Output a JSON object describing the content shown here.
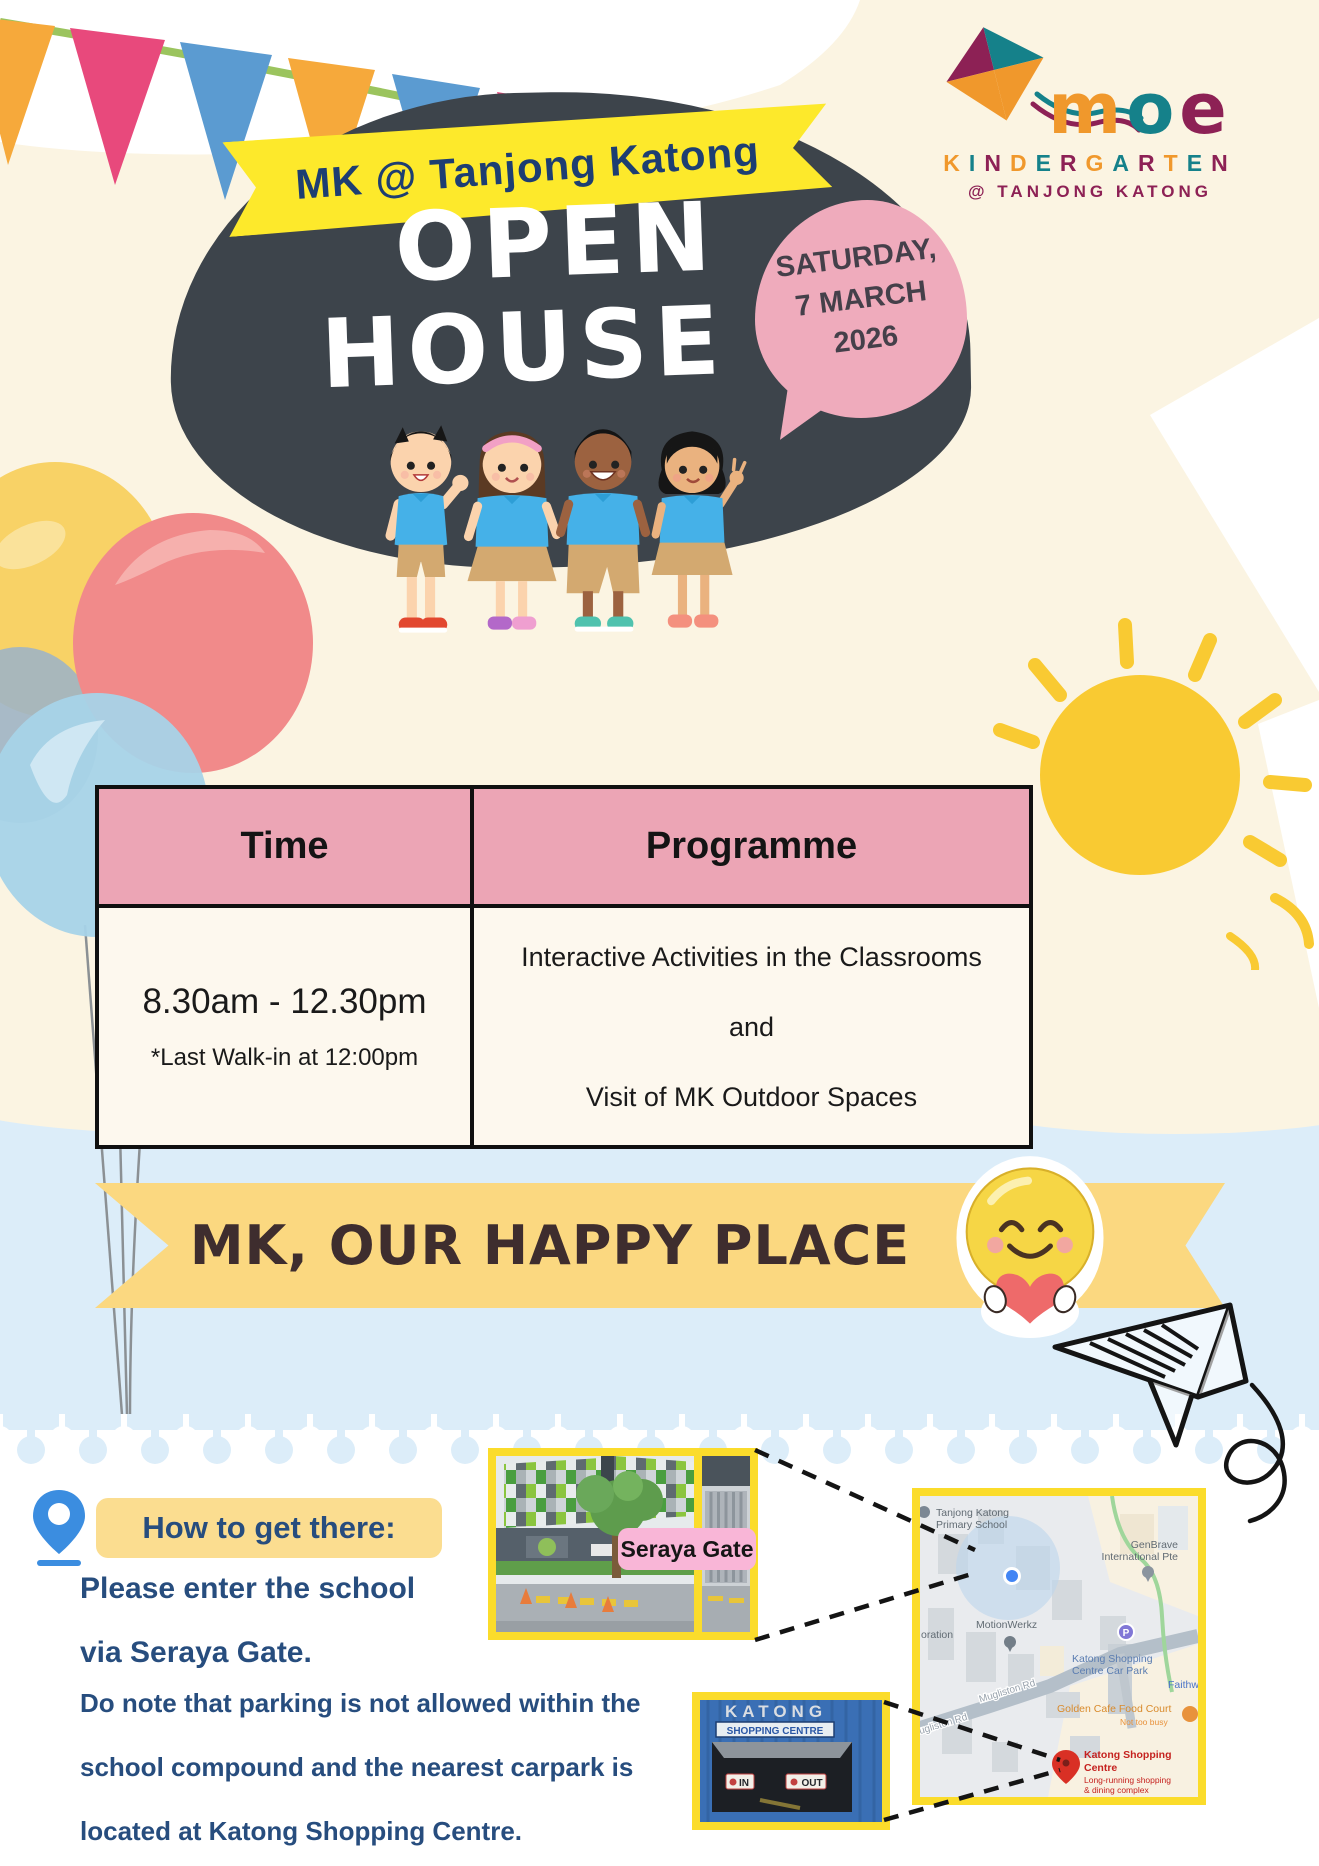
{
  "colors": {
    "background_cream": "#fbf4e2",
    "background_sky": "#dcedf9",
    "blob_dark": "#3d444b",
    "banner_yellow": "#fde92b",
    "ribbon_yellow": "#fbd880",
    "bubble_pink": "#efabbc",
    "table_header_pink": "#eca5b5",
    "table_body_cream": "#fdf8ee",
    "navy_text": "#274d7e",
    "photo_border_yellow": "#fbdc2b",
    "gate_label_pink": "#f9b6d7",
    "highlight_yellow": "#fbdd90",
    "logo_orange": "#f0982c",
    "logo_teal": "#15818a",
    "logo_maroon": "#8d2155"
  },
  "logo": {
    "brand": "moe",
    "kindergarten": "KINDERGARTEN",
    "location": "@ TANJONG KATONG"
  },
  "hero": {
    "school_banner": "MK @ Tanjong Katong",
    "title_line1": "OPEN",
    "title_line2": "HOUSE",
    "date": {
      "line1": "SATURDAY,",
      "line2": "7 MARCH",
      "line3": "2026"
    }
  },
  "schedule": {
    "header_time": "Time",
    "header_programme": "Programme",
    "time": "8.30am - 12.30pm",
    "time_note": "*Last Walk-in at 12:00pm",
    "programme_line1": "Interactive Activities in the Classrooms",
    "programme_line2": "and",
    "programme_line3": "Visit of MK Outdoor Spaces"
  },
  "ribbon": {
    "text": "MK, OUR HAPPY PLACE"
  },
  "directions": {
    "heading": "How to get there:",
    "enter_line1": "Please enter the school",
    "enter_line2": "via Seraya Gate.",
    "gate_label": "Seraya Gate",
    "parking_line1": "Do note that parking is not allowed within the",
    "parking_line2": "school compound and the nearest carpark is",
    "parking_line3": "located at Katong Shopping Centre."
  },
  "map": {
    "school_line1": "Tanjong Katong",
    "school_line2": "Primary School",
    "genbrave_line1": "GenBrave",
    "genbrave_line2": "International Pte",
    "motionwerkz": "MotionWerkz",
    "partial_left": "oration",
    "road": "Mugliston Rd",
    "parking_letter": "P",
    "carpark_line1": "Katong Shopping",
    "carpark_line2": "Centre Car Park",
    "faith": "Faithwo",
    "food_court": "Golden Cafe Food Court",
    "food_court_note": "Not too busy",
    "ksc_line1": "Katong Shopping",
    "ksc_line2": "Centre",
    "ksc_line3": "Long-running shopping",
    "ksc_line4": "& dining complex"
  },
  "carpark_photo": {
    "name_top": "KATONG",
    "name_bottom": "SHOPPING CENTRE",
    "sign_in": "IN",
    "sign_out": "OUT"
  }
}
